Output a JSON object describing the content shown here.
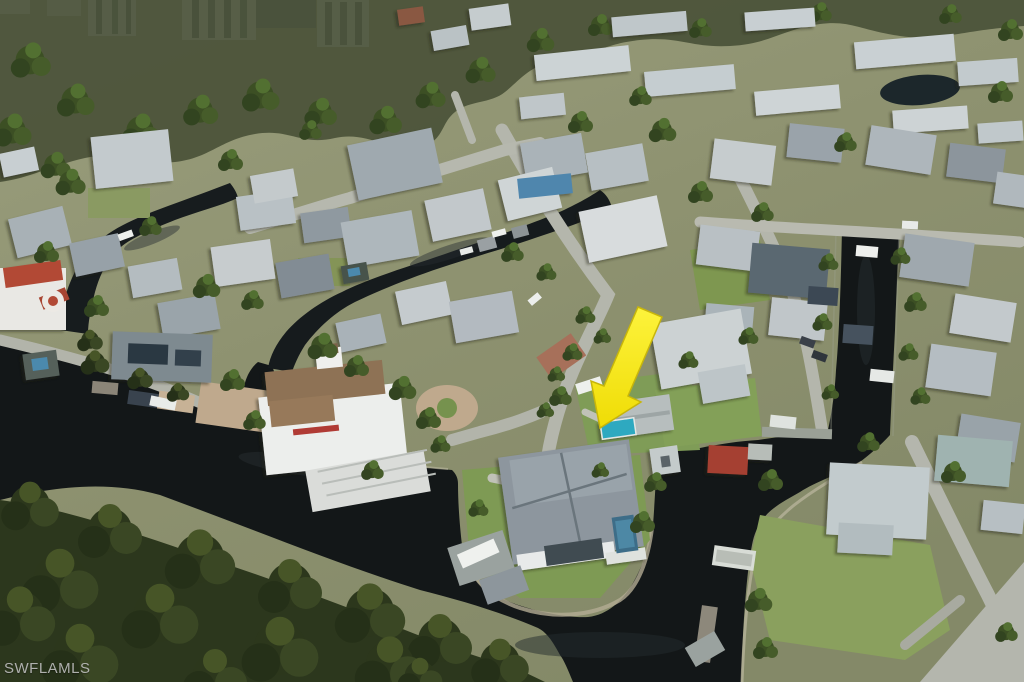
{
  "watermark": {
    "text": "SWFLAMLS"
  },
  "scene": {
    "type": "aerial-drone-photo",
    "subject": "Southwest Florida waterfront neighborhood with dark mangrove-lined canals, boat docks and single-family homes; dense forest in foreground, high-rise condo towers on horizon",
    "highlight": {
      "shape": "arrow",
      "color": "#F4E90E",
      "direction": "pointing down-left",
      "target": "waterfront home with teal pool beside canal point"
    },
    "landmarks": [
      "high-rise condo towers",
      "mangrove forest",
      "winding canals",
      "boat lifts and docks",
      "circular paver driveway",
      "bronze-roof estate with cupola",
      "gray hip-roof point house with pool"
    ],
    "palette": {
      "water": "#131718",
      "mangrove": "#2C361D",
      "grass": "#8E9070",
      "street": "#B4B6AC",
      "roof_gray": "#AEB6BB",
      "roof_bronze": "#8E7254",
      "pool_teal": "#2FA9C0",
      "arrow": "#F4E90E"
    }
  }
}
